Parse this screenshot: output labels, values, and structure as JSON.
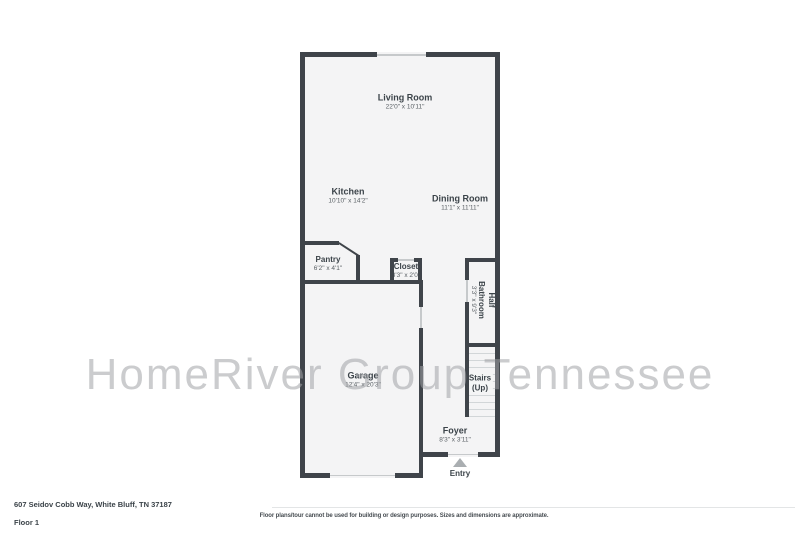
{
  "watermark": {
    "text": "HomeRiver Group Tennessee",
    "color": "#c6c8ca"
  },
  "floorplan": {
    "wall_color": "#3f444a",
    "floor_color": "#f4f4f5",
    "rooms": {
      "living_room": {
        "name": "Living Room",
        "dims": "22'0\" x 10'11\""
      },
      "kitchen": {
        "name": "Kitchen",
        "dims": "10'10\" x 14'2\""
      },
      "dining_room": {
        "name": "Dining Room",
        "dims": "11'1\" x 11'11\""
      },
      "pantry": {
        "name": "Pantry",
        "dims": "6'2\" x 4'1\""
      },
      "closet": {
        "name": "Closet",
        "dims": "3'3\" x 2'0\""
      },
      "half_bathroom": {
        "line1": "Half",
        "line2": "Bathroom",
        "dims": "3'3\" x 9'3\""
      },
      "stairs": {
        "line1": "Stairs",
        "line2": "(Up)"
      },
      "garage": {
        "name": "Garage",
        "dims": "12'4\" x 20'3\""
      },
      "foyer": {
        "name": "Foyer",
        "dims": "8'3\" x 3'11\""
      }
    },
    "entry_label": "Entry"
  },
  "footer": {
    "address": "607 Seidov Cobb Way, White Bluff, TN 37187",
    "floor_label": "Floor 1",
    "disclaimer": "Floor plans/tour cannot be used for building or design purposes. Sizes and dimensions are approximate."
  }
}
